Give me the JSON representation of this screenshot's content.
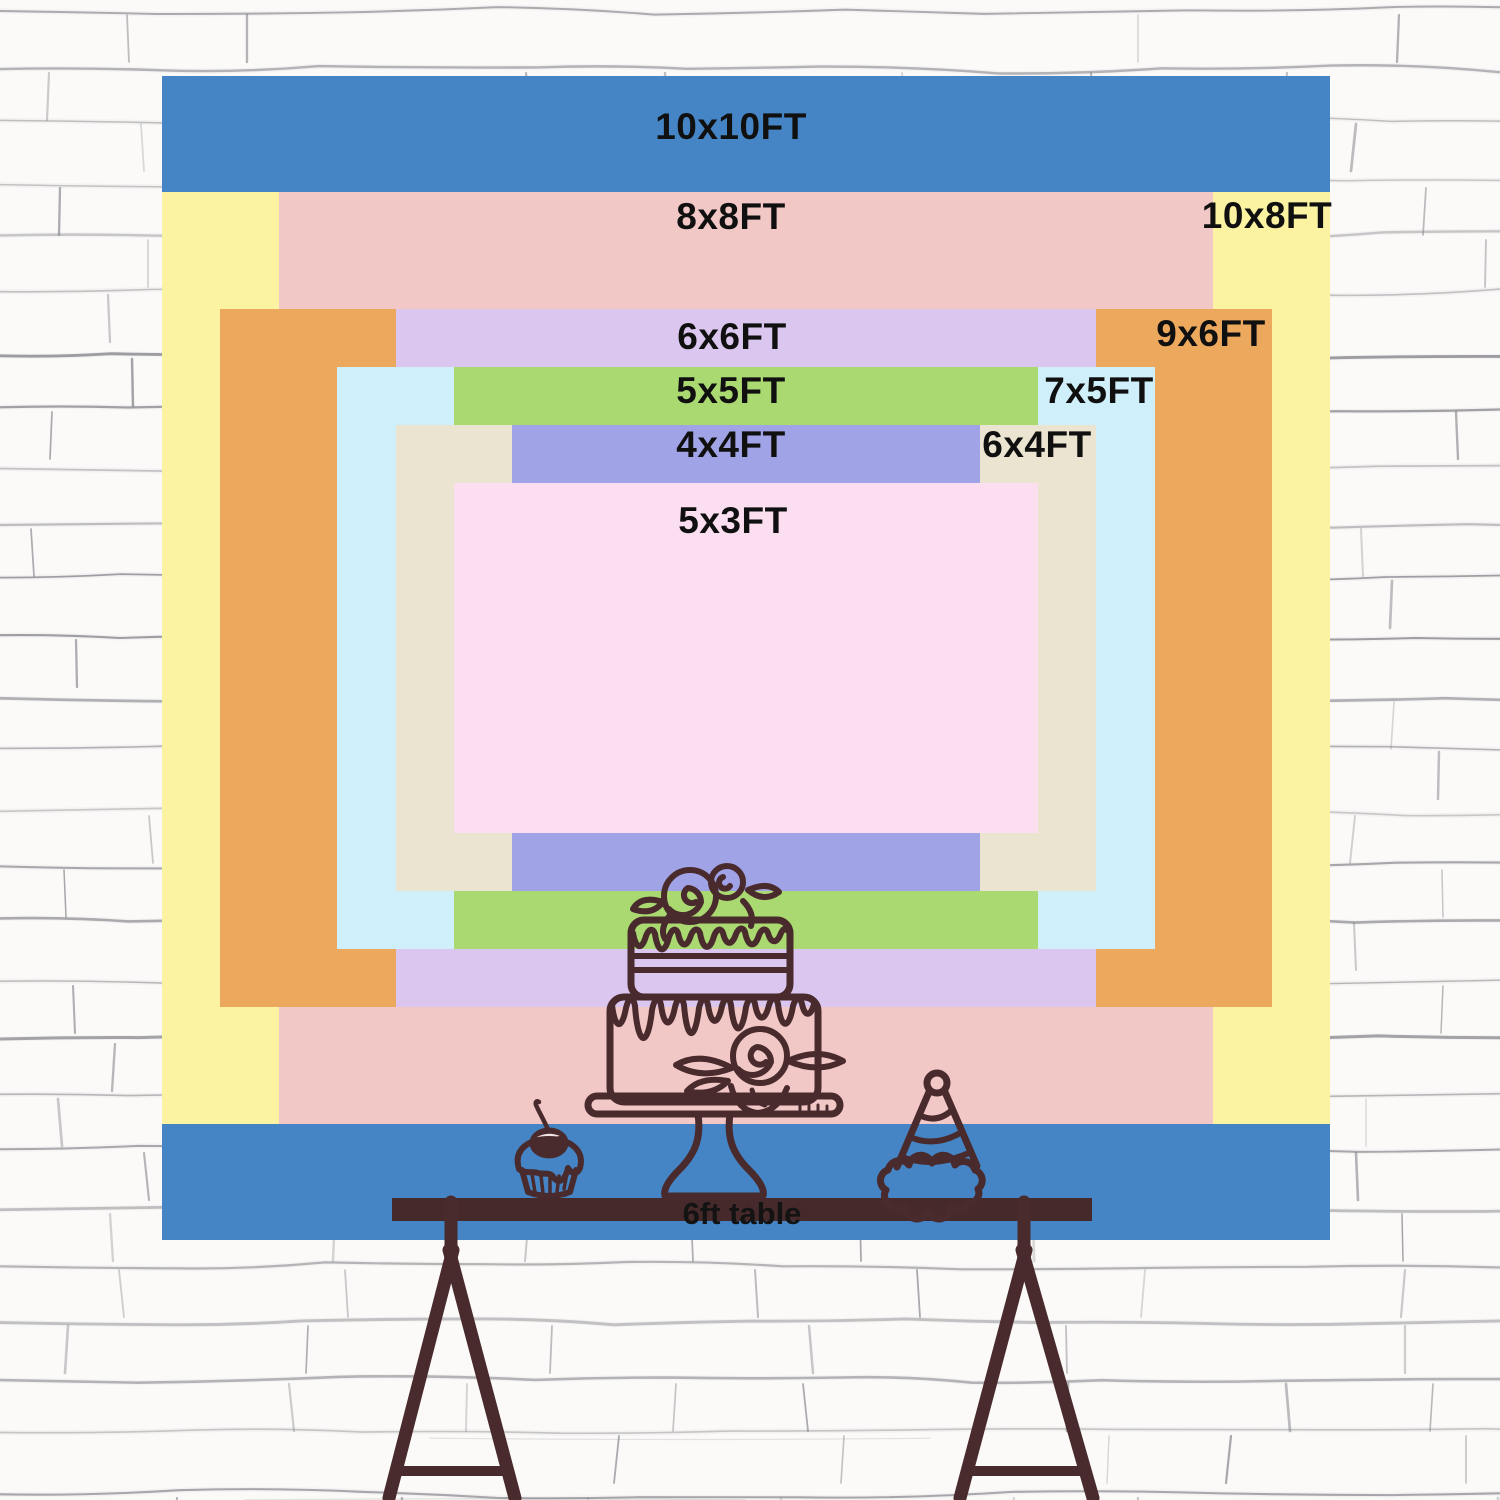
{
  "backdrop": {
    "label_color": "#101010",
    "sizes": [
      {
        "label": "10x10FT",
        "width_ft": 10,
        "height_ft": 10,
        "color": "#4585c6"
      },
      {
        "label": "10x8FT",
        "width_ft": 10,
        "height_ft": 8,
        "color": "#fbf3a2"
      },
      {
        "label": "8x8FT",
        "width_ft": 8,
        "height_ft": 8,
        "color": "#f2c8c7"
      },
      {
        "label": "9x6FT",
        "width_ft": 9,
        "height_ft": 6,
        "color": "#eca95e"
      },
      {
        "label": "6x6FT",
        "width_ft": 6,
        "height_ft": 6,
        "color": "#dbc6ef"
      },
      {
        "label": "7x5FT",
        "width_ft": 7,
        "height_ft": 5,
        "color": "#cfeffa"
      },
      {
        "label": "5x5FT",
        "width_ft": 5,
        "height_ft": 5,
        "color": "#abd971"
      },
      {
        "label": "6x4FT",
        "width_ft": 6,
        "height_ft": 4,
        "color": "#eae4d1"
      },
      {
        "label": "4x4FT",
        "width_ft": 4,
        "height_ft": 4,
        "color": "#a0a4e6"
      },
      {
        "label": "5x3FT",
        "width_ft": 5,
        "height_ft": 3,
        "color": "#fbdff0"
      }
    ]
  },
  "table": {
    "label": "6ft table",
    "color": "#46292a"
  },
  "illustration": {
    "stroke_color": "#4a2b2d",
    "items": [
      "tiered-cake-icon",
      "cupcake-icon",
      "party-hat-icon",
      "trestle-table-icon",
      "brick-wall-background"
    ]
  }
}
